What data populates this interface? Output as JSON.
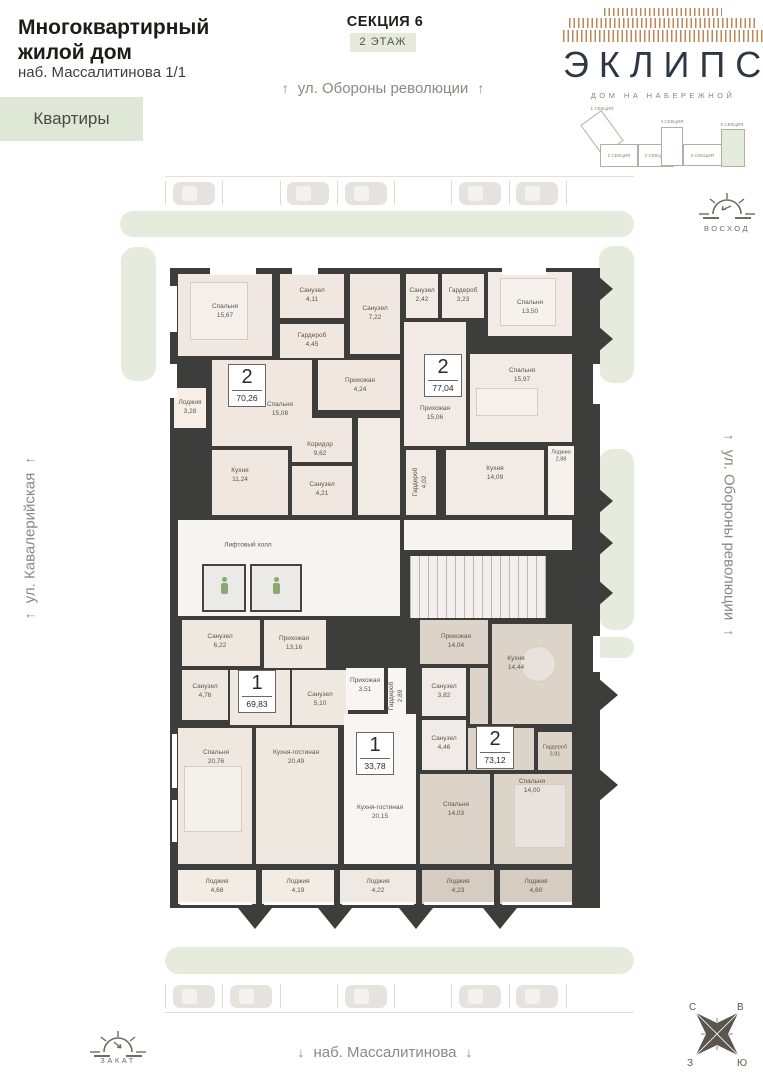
{
  "header": {
    "building_type": "Многоквартирный жилой дом",
    "address": "наб. Массалитинова 1/1",
    "apartments_button": "Квартиры",
    "section": "СЕКЦИЯ 6",
    "floor": "2 ЭТАЖ"
  },
  "logo": {
    "name": "ЭКЛИПС",
    "tagline": "ДОМ НА НАБЕРЕЖНОЙ"
  },
  "sections_map": {
    "items": [
      "1 СЕКЦИЯ",
      "2 СЕКЦИЯ",
      "3 СЕКЦИЯ",
      "4 СЕКЦИЯ",
      "5 СЕКЦИЯ",
      "6 СЕКЦИЯ"
    ],
    "active": "6 СЕКЦИЯ"
  },
  "streets": {
    "top": "ул. Обороны революции",
    "right": "ул. Обороны революции",
    "left": "ул. Кавалерийская",
    "bottom": "наб. Массалитинова"
  },
  "arrows": {
    "up": "↑",
    "down": "↓"
  },
  "sun": {
    "sunrise_label": "ВОСХОД",
    "sunset_label": "ЗАКАТ"
  },
  "compass": {
    "north": "С",
    "east": "В",
    "west": "З",
    "south": "Ю"
  },
  "apartments": [
    {
      "rooms_count": "2",
      "area": "70,26"
    },
    {
      "rooms_count": "2",
      "area": "77,04"
    },
    {
      "rooms_count": "1",
      "area": "69,83"
    },
    {
      "rooms_count": "1",
      "area": "33,78"
    },
    {
      "rooms_count": "2",
      "area": "73,12"
    }
  ],
  "common": {
    "elevator_hall": "Лифтовый холл"
  },
  "rooms": [
    {
      "name": "Спальня",
      "area": "15,67"
    },
    {
      "name": "Санузел",
      "area": "4,11"
    },
    {
      "name": "Санузел",
      "area": "7,22"
    },
    {
      "name": "Гардероб",
      "area": "4,45"
    },
    {
      "name": "Прихожая",
      "area": "4,24"
    },
    {
      "name": "Лоджия",
      "area": "3,28"
    },
    {
      "name": "Спальня",
      "area": "15,08"
    },
    {
      "name": "Кухня",
      "area": "11,24"
    },
    {
      "name": "Коридор",
      "area": "9,62"
    },
    {
      "name": "Санузел",
      "area": "4,21"
    },
    {
      "name": "Санузел",
      "area": "2,42"
    },
    {
      "name": "Гардероб",
      "area": "3,23"
    },
    {
      "name": "Спальня",
      "area": "13,50"
    },
    {
      "name": "Спальня",
      "area": "15,97"
    },
    {
      "name": "Прихожая",
      "area": "15,06"
    },
    {
      "name": "Гардероб",
      "area": "4,02"
    },
    {
      "name": "Кухня",
      "area": "14,09"
    },
    {
      "name": "Лоджия",
      "area": "2,88"
    },
    {
      "name": "Санузел",
      "area": "6,22"
    },
    {
      "name": "Прихожая",
      "area": "13,16"
    },
    {
      "name": "Санузел",
      "area": "4,76"
    },
    {
      "name": "Санузел",
      "area": "5,10"
    },
    {
      "name": "Спальня",
      "area": "20,76"
    },
    {
      "name": "Кухня-гостиная",
      "area": "20,49"
    },
    {
      "name": "Прихожая",
      "area": "3,51"
    },
    {
      "name": "Гардероб",
      "area": "2,89"
    },
    {
      "name": "Кухня-гостиная",
      "area": "20,15"
    },
    {
      "name": "Прихожая",
      "area": "14,04"
    },
    {
      "name": "Санузел",
      "area": "3,82"
    },
    {
      "name": "Санузел",
      "area": "4,46"
    },
    {
      "name": "Кухня",
      "area": "14,44"
    },
    {
      "name": "Гардероб",
      "area": "3,91"
    },
    {
      "name": "Спальня",
      "area": "14,03"
    },
    {
      "name": "Спальня",
      "area": "14,00"
    },
    {
      "name": "Лоджия",
      "area": "4,68"
    },
    {
      "name": "Лоджия",
      "area": "4,19"
    },
    {
      "name": "Лоджия",
      "area": "4,22"
    },
    {
      "name": "Лоджия",
      "area": "4,23"
    },
    {
      "name": "Лоджия",
      "area": "4,60"
    }
  ],
  "colors": {
    "accent_green": "#e6ecdd",
    "wall": "#3d3d3b",
    "room_beige": "#efe7e0",
    "room_taupe": "#dcd3c9",
    "logo_navy": "#2d3844",
    "logo_accent": "#c28556"
  }
}
